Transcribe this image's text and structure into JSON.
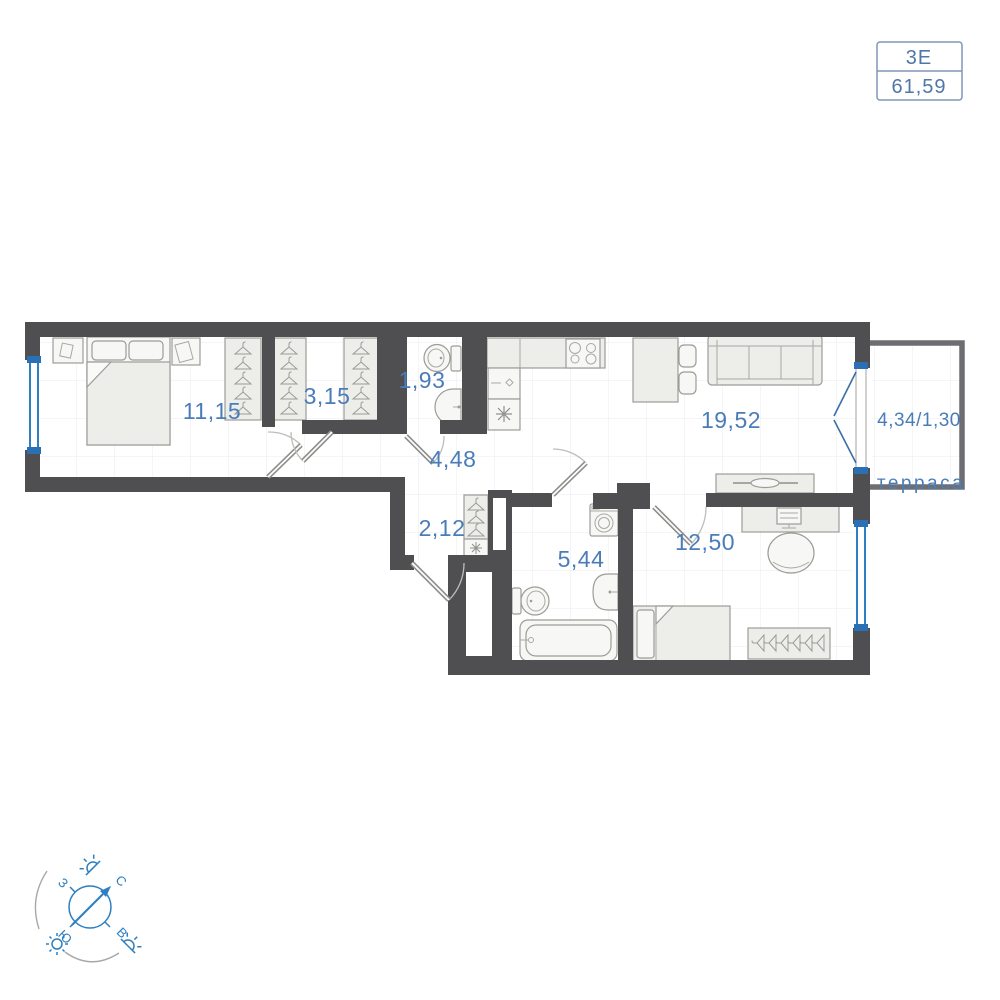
{
  "badge": {
    "plan_code": "3Е",
    "total_area": "61,59"
  },
  "areas": {
    "bedroom": "11,15",
    "wardrobe": "3,15",
    "bathroom_small": "1,93",
    "hallway": "4,48",
    "kitchen_living": "19,52",
    "corridor": "2,12",
    "bathroom": "5,44",
    "bedroom2": "12,50",
    "terrace": "4,34/1,30"
  },
  "labels": {
    "terrace": "терраса"
  },
  "compass": {
    "north": "С",
    "east": "В",
    "south": "Ю",
    "west": "З"
  },
  "colors": {
    "wall": "#4f4f52",
    "terrace_wall": "#6e6e72",
    "window_blue": "#2e7fc2",
    "label_blue": "#4a7db8",
    "badge_border": "#8095b5",
    "furniture_fill": "#ededea",
    "furniture_stroke": "#9c9c98"
  }
}
